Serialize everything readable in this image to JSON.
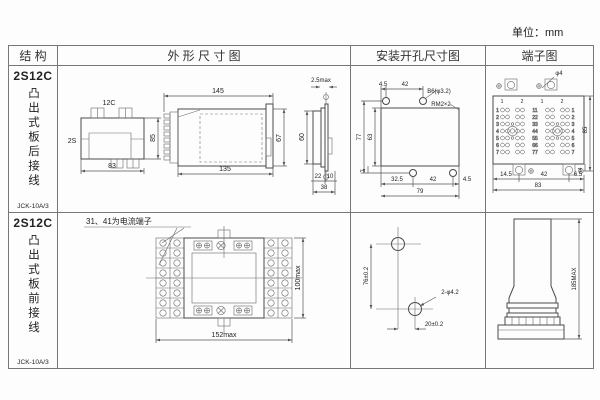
{
  "page": {
    "unit": "单位：mm"
  },
  "headers": {
    "structure": "结 构",
    "outline": "外 形 尺 寸 图",
    "mounting": "安装开孔尺寸图",
    "terminal": "端子图"
  },
  "row1": {
    "model": "2S12C",
    "wiring": "凸出式板后接线",
    "socket": "JCK-10A/3",
    "front": {
      "top": "12C",
      "left": "2S",
      "h": "85",
      "w": "83"
    },
    "side": {
      "top": "145",
      "bottom": "135",
      "h": "67"
    },
    "flange": {
      "top": "2.5max",
      "h": "60",
      "d1": "22",
      "d2": "10",
      "total": "38"
    },
    "mount": {
      "t1": "4.5",
      "t2": "42",
      "hole": "B6(φ3.2)",
      "corner": "RM2×2",
      "l1": "77",
      "l2": "63",
      "b0": "7",
      "b1": "32.5",
      "b2": "42",
      "b3": "4.5",
      "total": "79"
    },
    "term": {
      "hole": "φ4",
      "h": "85",
      "tab_h": "4",
      "b1": "14.5",
      "b2": "42",
      "b3": "6.5",
      "total": "83",
      "tabs": [
        "1",
        "2",
        "1",
        "2"
      ],
      "rows": [
        "1",
        "2",
        "3",
        "4",
        "5",
        "6",
        "7"
      ],
      "mids": [
        "11",
        "22",
        "33",
        "44",
        "55",
        "66",
        "77"
      ]
    }
  },
  "row2": {
    "model": "2S12C",
    "wiring": "凸出式板前接线",
    "socket": "JCK-10A/3",
    "note": "31、41为电流端子",
    "front": {
      "w": "152max",
      "h": "100max"
    },
    "mount": {
      "v": "76±0.2",
      "hole": "2-φ4.2",
      "hz": "20±0.2"
    },
    "side": {
      "h": "185MAX"
    }
  }
}
